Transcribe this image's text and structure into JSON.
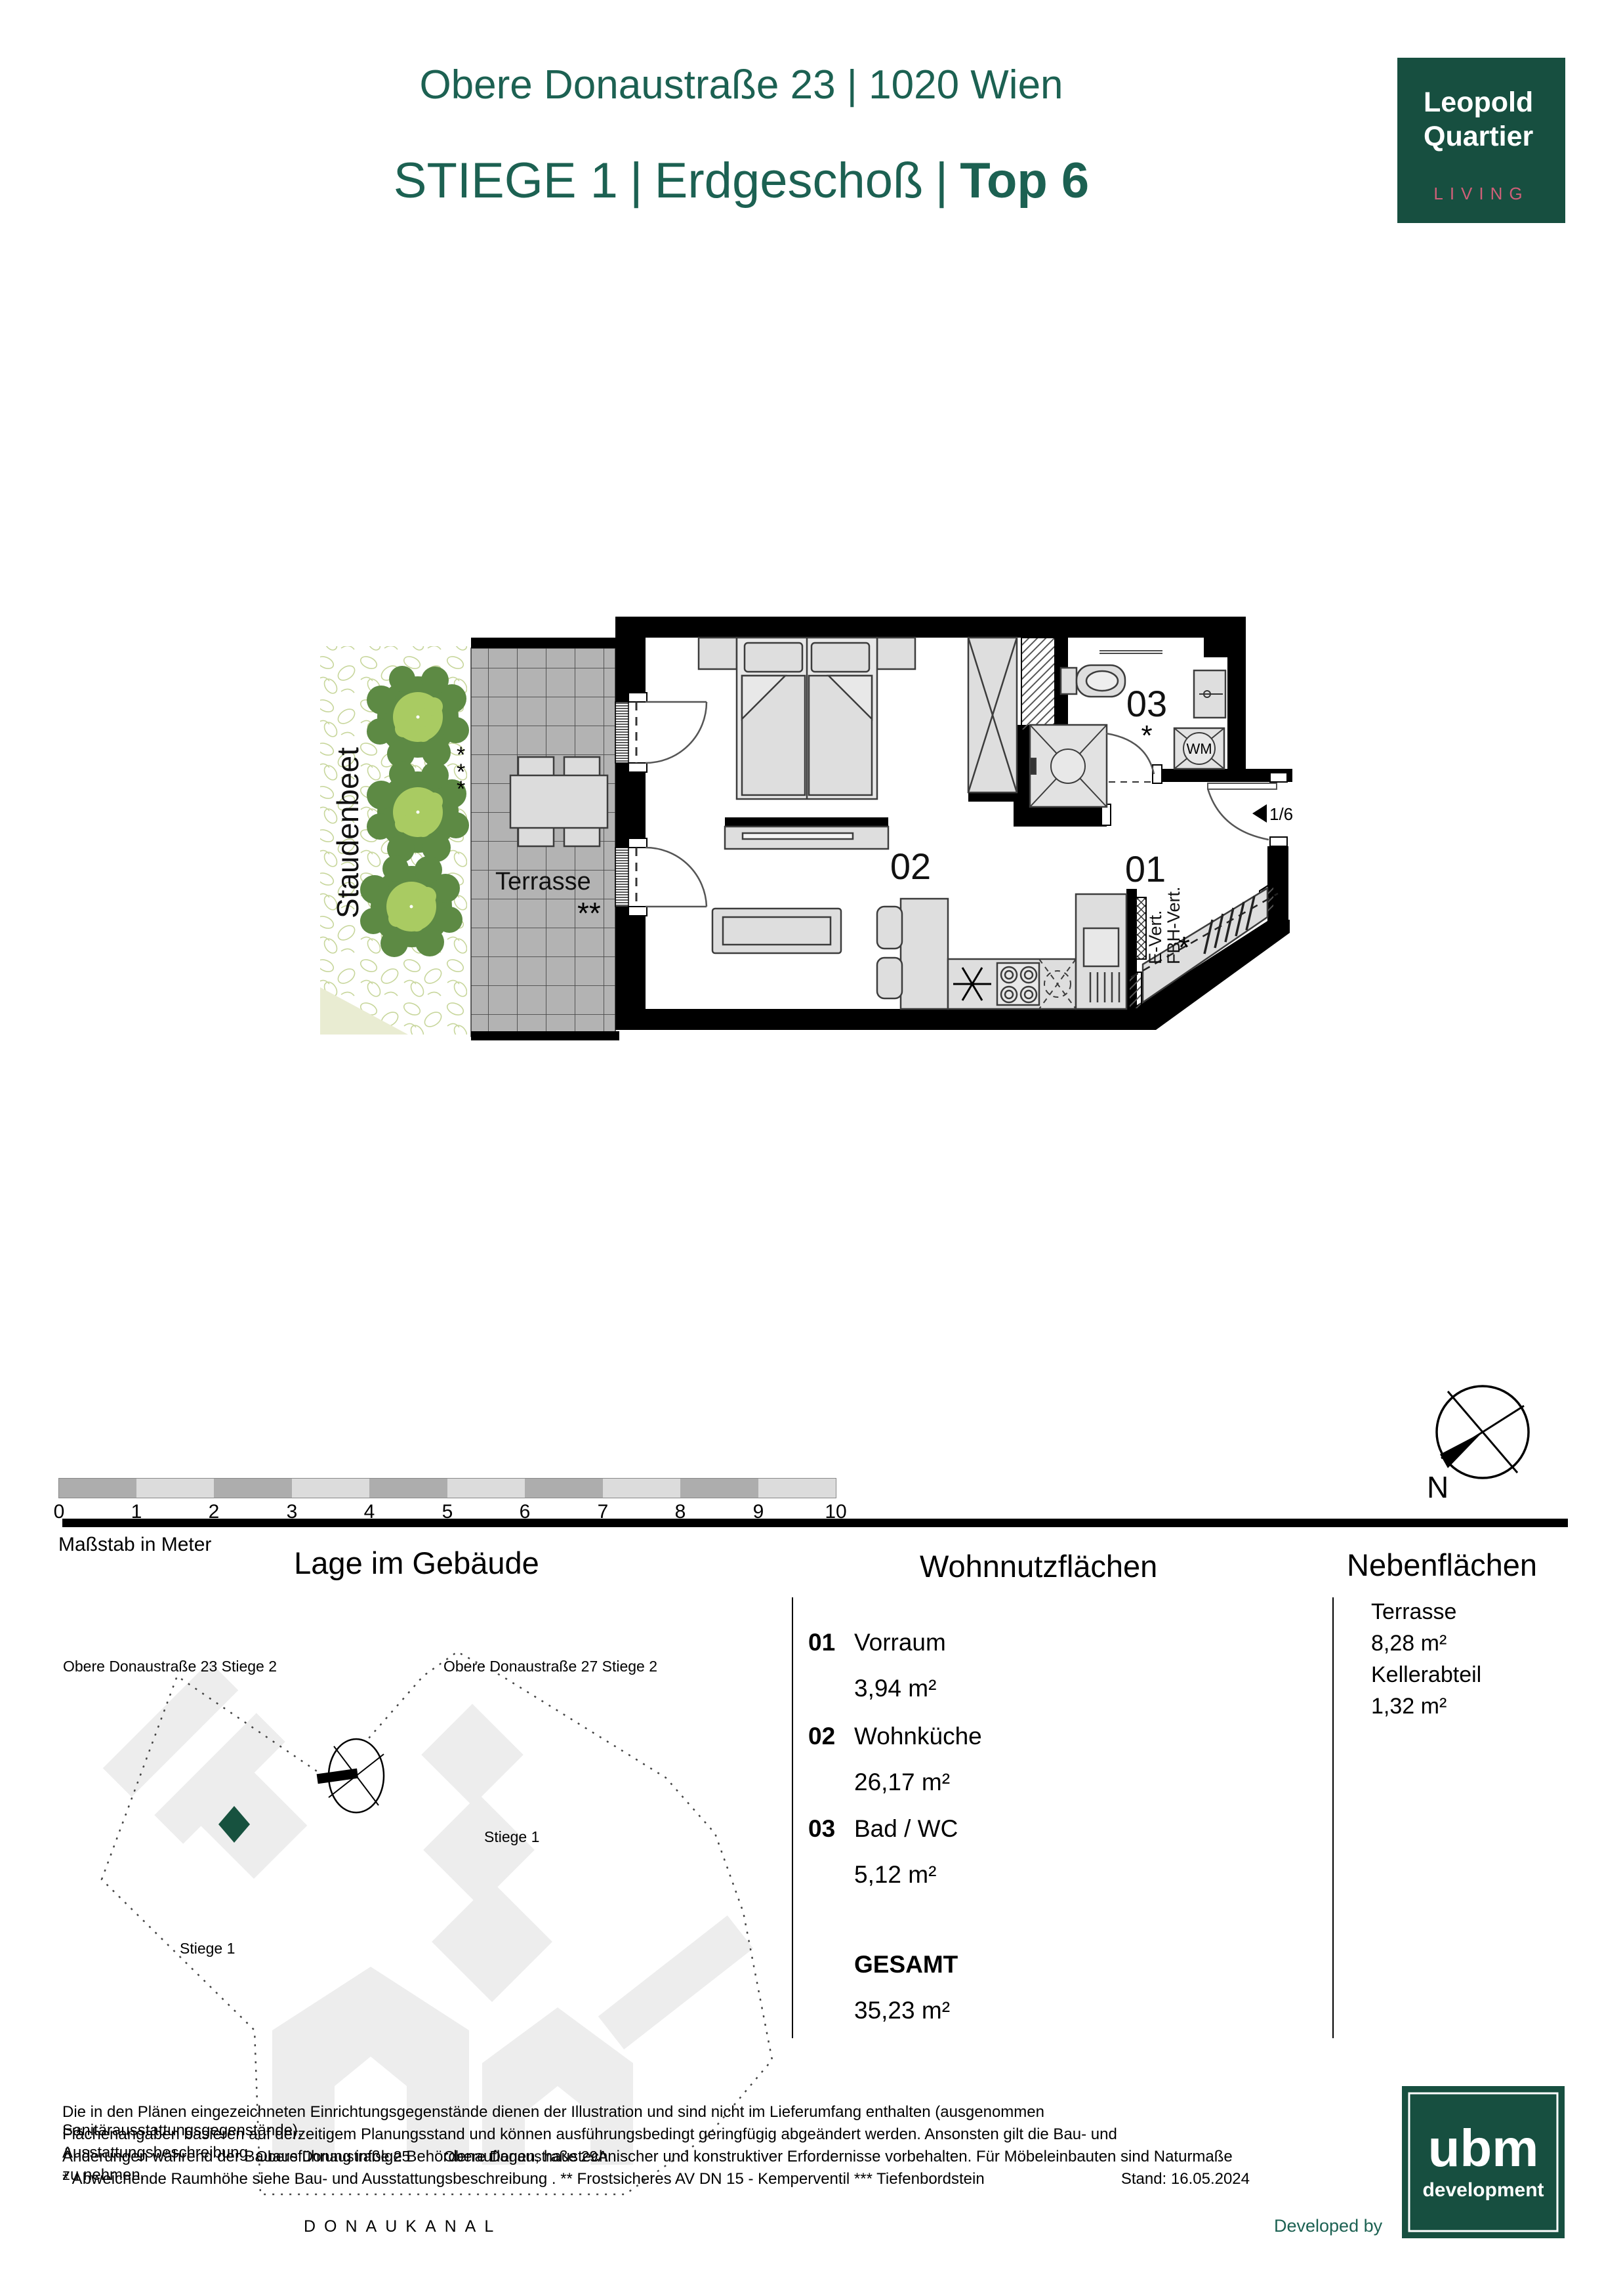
{
  "header": {
    "address": "Obere Donaustraße 23 | 1020 Wien",
    "stiege": "STIEGE 1",
    "sep": "|",
    "floor": "Erdgeschoß",
    "unit": "Top 6"
  },
  "brand": {
    "line1": "Leopold",
    "line2": "Quartier",
    "living": "LIVING"
  },
  "plan": {
    "staudenbeet": "Staudenbeet",
    "terrasse": "Terrasse",
    "room01": "01",
    "room02": "02",
    "room03": "03",
    "wm": "WM",
    "door_ratio": "1/6",
    "evert": "E-Vert.",
    "fbhvert": "FBH-Vert.",
    "star": "*",
    "stars2": "**"
  },
  "scalebar": {
    "ticks": [
      "0",
      "1",
      "2",
      "3",
      "4",
      "5",
      "6",
      "7",
      "8",
      "9",
      "10"
    ],
    "caption": "Maßstab in Meter"
  },
  "compass": {
    "north": "N"
  },
  "sections": {
    "lage": {
      "title": "Lage im Gebäude",
      "od23": "Obere Donaustraße 23 Stiege 2",
      "od27": "Obere Donaustraße 27 Stiege 2",
      "od25": "Obere Donaustraße 25",
      "od29a": "Obere Donaustraße 29A",
      "stiege1_left": "Stiege 1",
      "stiege1_right": "Stiege 1",
      "donaukanal": "DONAUKANAL"
    },
    "wohn": {
      "title": "Wohnnutzflächen",
      "items": [
        {
          "no": "01",
          "name": "Vorraum",
          "area": "3,94 m²"
        },
        {
          "no": "02",
          "name": "Wohnküche",
          "area": "26,17 m²"
        },
        {
          "no": "03",
          "name": "Bad / WC",
          "area": "5,12 m²"
        }
      ],
      "total_label": "GESAMT",
      "total_area": "35,23 m²"
    },
    "neben": {
      "title": "Nebenflächen",
      "items": [
        {
          "name": "Terrasse",
          "area": "8,28 m²"
        },
        {
          "name": "Kellerabteil",
          "area": "1,32 m²"
        }
      ]
    }
  },
  "footer": {
    "lines": [
      "Die in den Plänen eingezeichneten Einrichtungsgegenstände dienen der Illustration und sind nicht im Lieferumfang enthalten (ausgenommen Sanitärausstattungsgegenstände).",
      "Flächenangaben basieren auf derzeitigem Planungsstand und können ausführungsbedingt geringfügig abgeändert werden. Ansonsten gilt die Bau- und Ausstattungsbeschreibung.",
      "Änderungen während der Bauausführung infolge Behördenauflagen, haustechnischer und konstruktiver Erfordernisse vorbehalten. Für Möbeleinbauten sind Naturmaße zu nehmen.",
      "* Abweichende Raumhöhe siehe Bau- und Ausstattungsbeschreibung . ** Frostsicheres AV DN 15 - Kemperventil  *** Tiefenbordstein"
    ],
    "stand": "Stand: 16.05.2024",
    "developed_by": "Developed by",
    "ubm_name": "ubm",
    "ubm_sub": "development"
  }
}
